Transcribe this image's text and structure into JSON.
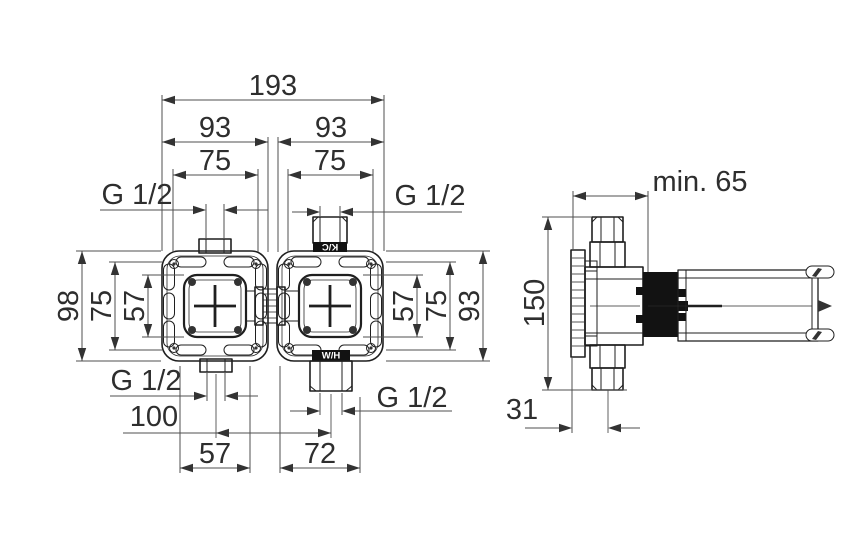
{
  "colors": {
    "background": "#ffffff",
    "object_line": "#1f1f1f",
    "dimension_line": "#4f4f4f",
    "text": "#2e2e2e",
    "dark_fill": "#121212",
    "port_label_text": "#ffffff"
  },
  "front_view": {
    "dim_overall_width": "193",
    "dim_left_width": "93",
    "dim_right_width": "93",
    "dim_left_port_span": "75",
    "dim_right_port_span": "75",
    "dim_height_overall": "98",
    "dim_height_flange": "75",
    "dim_height_body": "57",
    "dim_right_height_body": "57",
    "dim_right_height_flange": "75",
    "dim_right_height_overall": "93",
    "dim_port_spacing": "100",
    "dim_bottom_left_span": "57",
    "dim_bottom_right_span": "72",
    "thread_top_left": "G 1/2",
    "thread_top_right": "G 1/2",
    "thread_bottom_left": "G 1/2",
    "thread_bottom_right": "G 1/2",
    "port_label_cold": "K/C",
    "port_label_hot": "W/H"
  },
  "side_view": {
    "dim_min_depth": "min. 65",
    "dim_height": "150",
    "dim_flange_offset": "31"
  }
}
